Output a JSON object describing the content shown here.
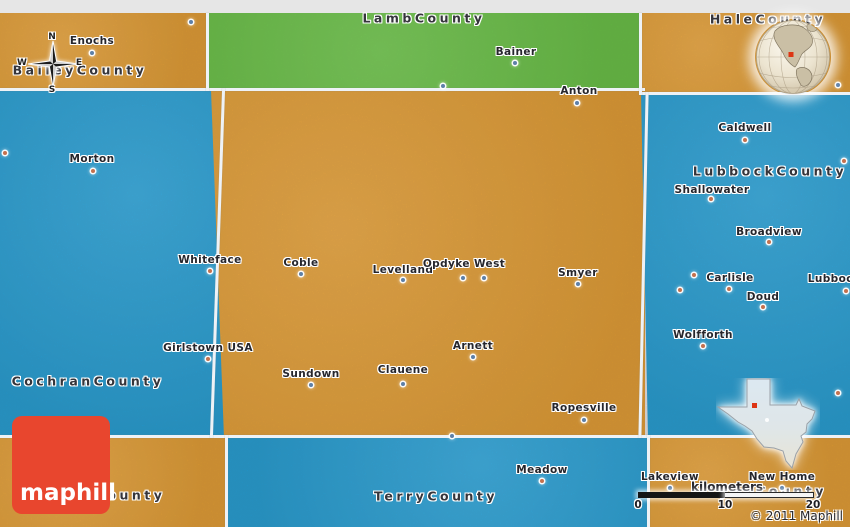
{
  "colors": {
    "orange": "#efa22b",
    "green": "#63cb3f",
    "blue": "#17a5e5",
    "gray_edge": "#e6e6e6",
    "border_line": "#eef2f6",
    "logo_red": "#e8462e",
    "label_dark": "#35353b",
    "dot_on_orange": "#5d80a8",
    "dot_on_blue": "#c4714e",
    "marker_red": "#dd3514"
  },
  "branding": {
    "logo_text": "maphill",
    "copyright": "© 2011 Maphill"
  },
  "compass": {
    "north": "N",
    "south": "S",
    "east": "E",
    "west": "W"
  },
  "scale_bar": {
    "unit_label": "kilometers",
    "ticks": [
      "0",
      "10",
      "20"
    ]
  },
  "insets": {
    "globe": {
      "name": "globe-locator-north-america",
      "marker": "map-location"
    },
    "texas": {
      "name": "texas-state-locator",
      "marker": "county-location"
    }
  },
  "counties": [
    {
      "label": "BaileyCounty",
      "x": 80,
      "y": 70
    },
    {
      "label": "LambCounty",
      "x": 424,
      "y": 18
    },
    {
      "label": "HaleCounty",
      "x": 768,
      "y": 19
    },
    {
      "label": "CochranCounty",
      "x": 88,
      "y": 381
    },
    {
      "label": "LubbockCounty",
      "x": 770,
      "y": 171
    },
    {
      "label": "YoakumCounty",
      "x": 92,
      "y": 495
    },
    {
      "label": "TerryCounty",
      "x": 436,
      "y": 496
    },
    {
      "label": "LynnCounty",
      "x": 768,
      "y": 491
    }
  ],
  "towns": [
    {
      "name": "Enochs",
      "lx": 92,
      "ly": 41,
      "dx": 92,
      "dy": 53,
      "on": "orange"
    },
    {
      "name": "Bainer",
      "lx": 516,
      "ly": 52,
      "dx": 515,
      "dy": 63,
      "on": "green"
    },
    {
      "name": "Anton",
      "lx": 579,
      "ly": 91,
      "dx": 577,
      "dy": 103,
      "on": "orange"
    },
    {
      "name": "Morton",
      "lx": 92,
      "ly": 159,
      "dx": 93,
      "dy": 171,
      "on": "blue"
    },
    {
      "name": "Whiteface",
      "lx": 210,
      "ly": 260,
      "dx": 210,
      "dy": 271,
      "on": "blue"
    },
    {
      "name": "Coble",
      "lx": 301,
      "ly": 263,
      "dx": 301,
      "dy": 274,
      "on": "orange"
    },
    {
      "name": "Levelland",
      "lx": 403,
      "ly": 270,
      "dx": 403,
      "dy": 280,
      "on": "orange"
    },
    {
      "name": "Opdyke West",
      "lx": 464,
      "ly": 264,
      "dx": 463,
      "dy": 278,
      "on": "orange"
    },
    {
      "name": "Smyer",
      "lx": 578,
      "ly": 273,
      "dx": 578,
      "dy": 284,
      "on": "orange"
    },
    {
      "name": "Arnett",
      "lx": 473,
      "ly": 346,
      "dx": 473,
      "dy": 357,
      "on": "orange"
    },
    {
      "name": "Girlstown USA",
      "lx": 208,
      "ly": 348,
      "dx": 208,
      "dy": 359,
      "on": "blue"
    },
    {
      "name": "Sundown",
      "lx": 311,
      "ly": 374,
      "dx": 311,
      "dy": 385,
      "on": "orange"
    },
    {
      "name": "Clauene",
      "lx": 403,
      "ly": 370,
      "dx": 403,
      "dy": 384,
      "on": "orange"
    },
    {
      "name": "Ropesville",
      "lx": 584,
      "ly": 408,
      "dx": 584,
      "dy": 420,
      "on": "orange"
    },
    {
      "name": "Caldwell",
      "lx": 745,
      "ly": 128,
      "dx": 745,
      "dy": 140,
      "on": "blue"
    },
    {
      "name": "Shallowater",
      "lx": 712,
      "ly": 190,
      "dx": 711,
      "dy": 199,
      "on": "blue"
    },
    {
      "name": "Broadview",
      "lx": 769,
      "ly": 232,
      "dx": 769,
      "dy": 242,
      "on": "blue"
    },
    {
      "name": "Carlisle",
      "lx": 730,
      "ly": 278,
      "dx": 729,
      "dy": 289,
      "on": "blue"
    },
    {
      "name": "Lubbock",
      "lx": 834,
      "ly": 279,
      "dx": 846,
      "dy": 291,
      "on": "blue"
    },
    {
      "name": "Doud",
      "lx": 763,
      "ly": 297,
      "dx": 763,
      "dy": 307,
      "on": "blue"
    },
    {
      "name": "Wolfforth",
      "lx": 703,
      "ly": 335,
      "dx": 703,
      "dy": 346,
      "on": "blue"
    },
    {
      "name": "Meadow",
      "lx": 542,
      "ly": 470,
      "dx": 542,
      "dy": 481,
      "on": "blue"
    },
    {
      "name": "Lakeview",
      "lx": 670,
      "ly": 477,
      "dx": 670,
      "dy": 488,
      "on": "orange"
    },
    {
      "name": "New Home",
      "lx": 782,
      "ly": 477,
      "dx": 782,
      "dy": 488,
      "on": "orange"
    }
  ],
  "extra_dots": [
    {
      "x": 191,
      "y": 22,
      "on": "orange"
    },
    {
      "x": 443,
      "y": 86,
      "on": "green"
    },
    {
      "x": 838,
      "y": 85,
      "on": "orange"
    },
    {
      "x": 844,
      "y": 161,
      "on": "blue"
    },
    {
      "x": 694,
      "y": 275,
      "on": "blue"
    },
    {
      "x": 680,
      "y": 290,
      "on": "blue"
    },
    {
      "x": 484,
      "y": 278,
      "on": "orange"
    },
    {
      "x": 838,
      "y": 393,
      "on": "blue"
    },
    {
      "x": 452,
      "y": 436,
      "on": "orange"
    },
    {
      "x": 5,
      "y": 153,
      "on": "blue"
    }
  ]
}
